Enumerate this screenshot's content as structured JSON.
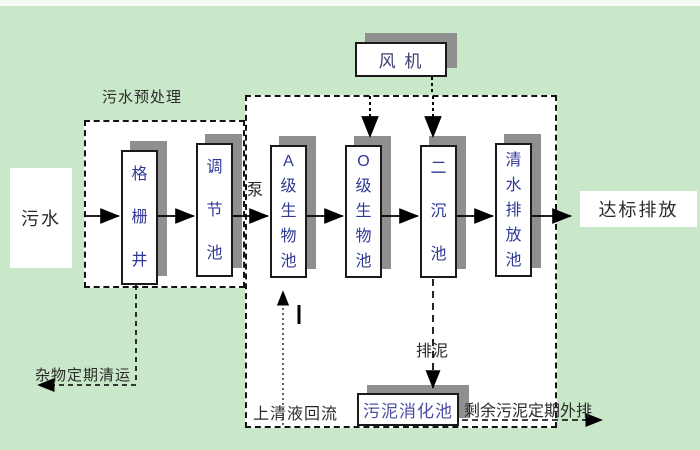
{
  "labels": {
    "influent": "污水",
    "pretreatment": "污水预处理",
    "pump": "泵",
    "fan": "风 机",
    "effluent": "达标排放",
    "debris_removal": "杂物定期清运",
    "supernatant_return": "上清液回流",
    "sludge_discharge": "排泥",
    "sludge_digestion_tank": "污泥消化池",
    "excess_sludge": "剩余污泥定期外排"
  },
  "tanks": [
    {
      "id": "grid-well",
      "label": "格栅井"
    },
    {
      "id": "regulating-tank",
      "label": "调节池"
    },
    {
      "id": "a-level-bio-tank",
      "label": "A级生物池"
    },
    {
      "id": "o-level-bio-tank",
      "label": "O级生物池"
    },
    {
      "id": "secondary-sedimentation-tank",
      "label": "二沉池"
    },
    {
      "id": "clean-water-discharge-tank",
      "label": "清水排放池"
    }
  ],
  "colors": {
    "background": "#c9e7c9",
    "box_fill": "#ffffff",
    "box_border": "#1a1a1a",
    "shadow": "#8f8f8f",
    "tank_text": "#2f3a96",
    "label_text": "#2b2b2b"
  }
}
